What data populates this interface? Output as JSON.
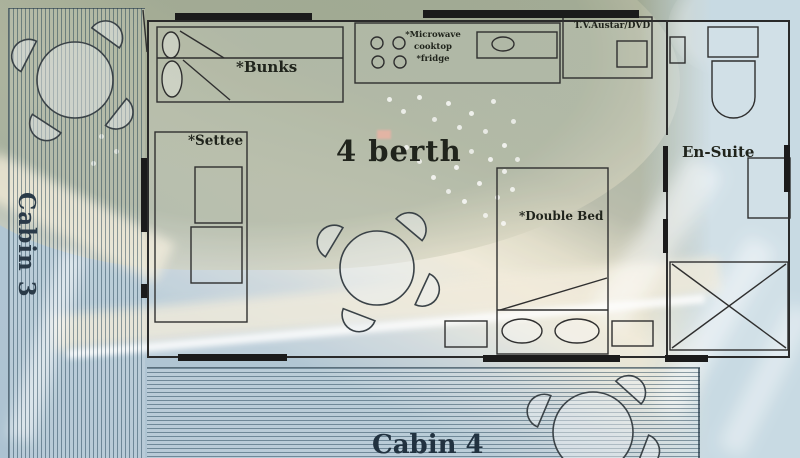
{
  "page": {
    "title": "4 berth cabin floor plan over aerial beach photo"
  },
  "plan": {
    "berth_label": "4 berth",
    "cabin3_label": "Cabin 3",
    "cabin4_label": "Cabin 4",
    "rooms": {
      "ensuite": "En-Suite"
    },
    "furniture": {
      "bunks": "*Bunks",
      "settee": "*Settee",
      "double_bed": "*Double Bed",
      "tv_unit": "T.V.Austar/DVD",
      "kitchen": {
        "line1": "*Microwave",
        "line2": "cooktop",
        "line3": "*fridge"
      }
    }
  },
  "colors": {
    "plan_line": "#2f2f2f",
    "window_bar": "#1b1b1b",
    "ink": "#20241c",
    "cabin_ink": "#2a3a48",
    "land": "#98a18b",
    "sand": "#ebe4ce",
    "ocean": "#a9c0cf",
    "deck_line": "#51707f"
  }
}
